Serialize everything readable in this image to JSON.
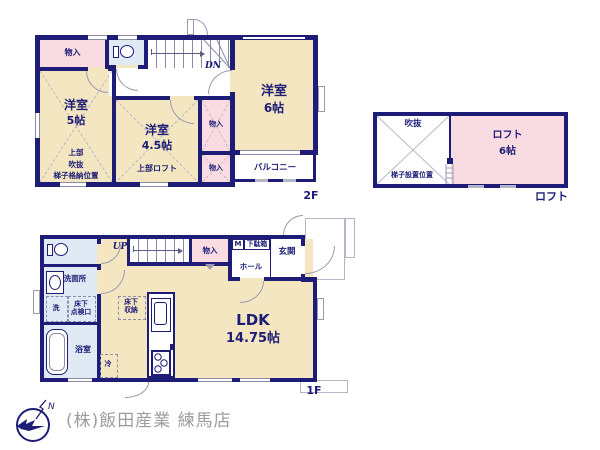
{
  "floor2": {
    "label": "2F",
    "stairs_label": "DN",
    "storage_top": "物入",
    "room5": {
      "name": "洋室",
      "size": "5帖",
      "note": "上部\n吹抜\n梯子格納位置"
    },
    "room45": {
      "name": "洋室",
      "size": "4.5帖",
      "note": "上部ロフト"
    },
    "room6": {
      "name": "洋室",
      "size": "6帖"
    },
    "closet_a": "物入",
    "closet_b": "物入",
    "balcony": "バルコニー"
  },
  "loft": {
    "label": "ロフト",
    "void": "吹抜",
    "ladder_note": "梯子設置位置",
    "room": {
      "name": "ロフト",
      "size": "6帖"
    }
  },
  "floor1": {
    "label": "1F",
    "stairs_label": "UP",
    "storage": "物入",
    "meter": "M",
    "shoebox": "下駄箱",
    "hall": "ホール",
    "entrance": "玄関",
    "washroom": "洗面所",
    "washer": "洗",
    "hatch": "床下\n点検口",
    "bathroom": "浴室",
    "floor_storage": "床下\n収納",
    "fridge": "冷",
    "ldk": {
      "name": "LDK",
      "size": "14.75帖"
    }
  },
  "footer": {
    "company": "(株)飯田産業 練馬店",
    "north": "N"
  },
  "colors": {
    "wall": "#1d1d78",
    "room": "#f4e6c0",
    "closet": "#f8dce2",
    "wet_area": "#dfeaf4",
    "company_text": "#9c9c9c"
  }
}
